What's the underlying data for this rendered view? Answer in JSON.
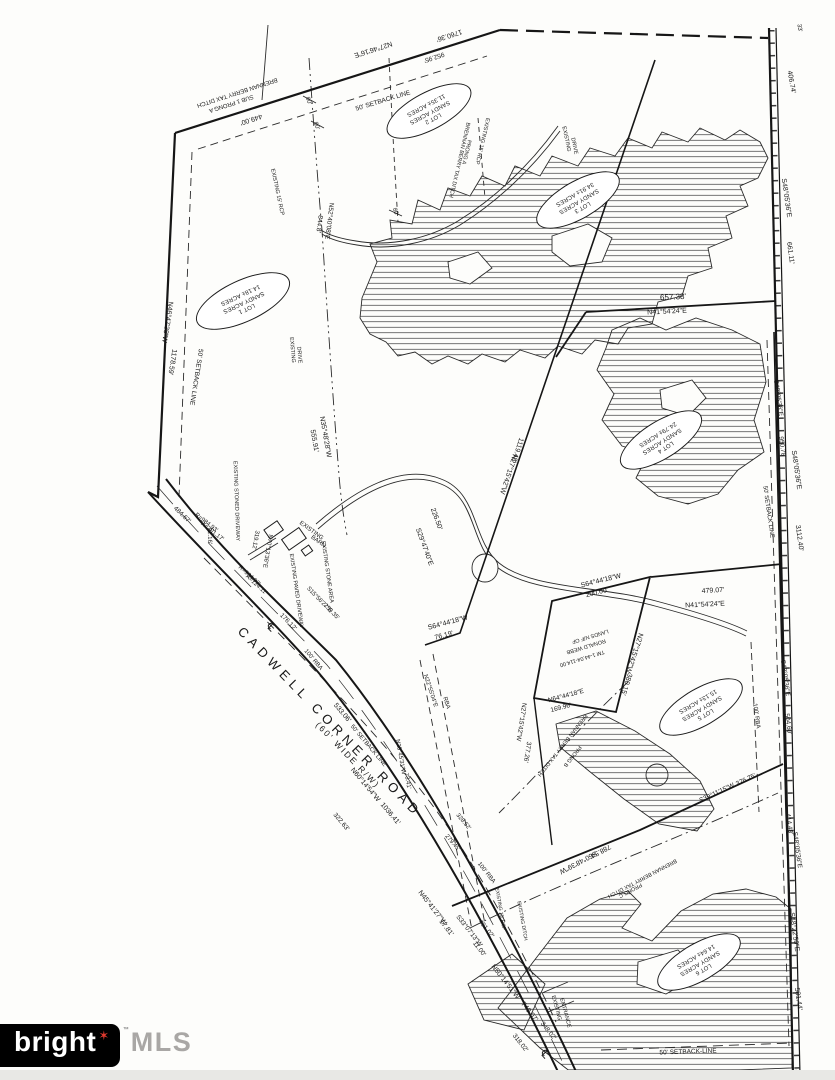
{
  "canvas": {
    "ink": "#1c1c1c",
    "paper": "#fdfdfb"
  },
  "logo": {
    "brand": "bright",
    "star": "✶",
    "tm": "™",
    "suffix": "MLS",
    "box_color": "#000000",
    "star_color": "#e0392e",
    "suffix_color": "#a9a7a5"
  },
  "road": {
    "name": "CADWELL CORNER ROAD",
    "width_label": "(60' WIDE R/W)",
    "centerline_symbol": "℄"
  },
  "lots": [
    {
      "lines": [
        "LOT 1",
        "SANDY ACRES",
        "14.18± ACRES"
      ],
      "x": 243,
      "y": 301,
      "r": 155,
      "w": 100,
      "h": 40
    },
    {
      "lines": [
        "LOT 2",
        "SANDY ACRES",
        "11.35± ACRES"
      ],
      "x": 429,
      "y": 111,
      "r": 152
    },
    {
      "lines": [
        "LOT 3",
        "SANDY ACRES",
        "34.91± ACRES"
      ],
      "x": 578,
      "y": 200,
      "r": 150
    },
    {
      "lines": [
        "LOT 4",
        "SANDY ACRES",
        "24.79± ACRES"
      ],
      "x": 661,
      "y": 440,
      "r": 148
    },
    {
      "lines": [
        "LOT 5",
        "SANDY ACRES",
        "15.13± ACRES"
      ],
      "x": 701,
      "y": 707,
      "r": 150
    },
    {
      "lines": [
        "LOT 6",
        "SANDY ACRES",
        "14.64± ACRES"
      ],
      "x": 699,
      "y": 962,
      "r": 150
    }
  ],
  "labels": [
    {
      "t": "N27°46'16\"E",
      "x": 373,
      "y": 49,
      "r": 162
    },
    {
      "t": "1760.36'",
      "x": 449,
      "y": 35,
      "r": 162
    },
    {
      "t": "952.95'",
      "x": 434,
      "y": 57,
      "r": 162,
      "s": 6.5
    },
    {
      "t": "50' SETBACK LINE",
      "x": 383,
      "y": 101,
      "r": -17,
      "s": 6.5
    },
    {
      "t": "449.00'",
      "x": 251,
      "y": 119,
      "r": 162
    },
    {
      "t": "BRENNAN BERRY TAX DITCH",
      "x": 237,
      "y": 92,
      "r": 162,
      "s": 6
    },
    {
      "t": "SUB 1 PRONG A",
      "x": 231,
      "y": 103,
      "r": 162,
      "s": 6
    },
    {
      "t": "80'",
      "x": 308,
      "y": 101,
      "r": 70,
      "s": 6
    },
    {
      "t": "80'",
      "x": 316,
      "y": 126,
      "r": 70,
      "s": 6
    },
    {
      "t": "80'",
      "x": 395,
      "y": 212,
      "r": 70,
      "s": 6
    },
    {
      "t": "EXISTING 15' RCP",
      "x": 277,
      "y": 192,
      "r": 78,
      "s": 5.5
    },
    {
      "t": "N52°40'08\"E",
      "x": 329,
      "y": 221,
      "r": 97,
      "s": 6.5
    },
    {
      "t": "844.8'",
      "x": 319,
      "y": 224,
      "r": 97,
      "s": 6.5
    },
    {
      "t": "EXISTING",
      "x": 566,
      "y": 139,
      "r": 78,
      "s": 5.5
    },
    {
      "t": "DRIVE",
      "x": 574,
      "y": 146,
      "r": 78,
      "s": 5.5
    },
    {
      "t": "BRENNAN BERRY TAX DITCH",
      "x": 459,
      "y": 160,
      "r": 103,
      "s": 5.5
    },
    {
      "t": "PRONG A",
      "x": 466,
      "y": 152,
      "r": 103,
      "s": 5.5
    },
    {
      "t": "EXISTING 15' RCP",
      "x": 482,
      "y": 141,
      "r": 103,
      "s": 5.5
    },
    {
      "t": "N46°47'38\"W",
      "x": 167,
      "y": 322,
      "r": 99
    },
    {
      "t": "1178.59'",
      "x": 172,
      "y": 362,
      "r": 99
    },
    {
      "t": "50' SETBACK LINE",
      "x": 196,
      "y": 377,
      "r": 99,
      "s": 6.5
    },
    {
      "t": "EXISTING",
      "x": 292,
      "y": 350,
      "r": 85,
      "s": 5.5
    },
    {
      "t": "DRIVE",
      "x": 299,
      "y": 355,
      "r": 85,
      "s": 5.5
    },
    {
      "t": "N35°48'28\"W",
      "x": 325,
      "y": 437,
      "r": 80
    },
    {
      "t": "555.91'",
      "x": 314,
      "y": 441,
      "r": 80
    },
    {
      "t": "S29°47'40\"E",
      "x": 424,
      "y": 547,
      "r": 70
    },
    {
      "t": "226.50'",
      "x": 436,
      "y": 519,
      "r": 70
    },
    {
      "t": "22.16'",
      "x": 209,
      "y": 536,
      "r": 88,
      "s": 6
    },
    {
      "t": "484.67'",
      "x": 182,
      "y": 515,
      "r": 44,
      "s": 6.5
    },
    {
      "t": "R=984.93'",
      "x": 206,
      "y": 523,
      "r": 38,
      "s": 6
    },
    {
      "t": "A=301.17'",
      "x": 212,
      "y": 532,
      "r": 38,
      "s": 6
    },
    {
      "t": "R=984.93'",
      "x": 249,
      "y": 576,
      "r": 42,
      "s": 6
    },
    {
      "t": "A=124.11'",
      "x": 256,
      "y": 585,
      "r": 42,
      "s": 6
    },
    {
      "t": "EXISTING STONED DRIVEWAY",
      "x": 236,
      "y": 501,
      "r": 88,
      "s": 5.5
    },
    {
      "t": "EXISTING PAVED DRIVEWAY",
      "x": 296,
      "y": 591,
      "r": 82,
      "s": 5.5
    },
    {
      "t": "EXISTING STONE AREA",
      "x": 327,
      "y": 572,
      "r": 82,
      "s": 5.5
    },
    {
      "t": "EXISTING",
      "x": 311,
      "y": 531,
      "r": 36,
      "s": 6
    },
    {
      "t": "BARN",
      "x": 318,
      "y": 542,
      "r": 36,
      "s": 6
    },
    {
      "t": "N70°13'36\"E",
      "x": 267,
      "y": 551,
      "r": 100,
      "s": 6
    },
    {
      "t": "319.12'",
      "x": 255,
      "y": 540,
      "r": 100,
      "s": 6
    },
    {
      "t": "S15°56'27\"E",
      "x": 319,
      "y": 600,
      "r": 46,
      "s": 6
    },
    {
      "t": "259.35'",
      "x": 331,
      "y": 612,
      "r": 46,
      "s": 6
    },
    {
      "t": "176.12'",
      "x": 288,
      "y": 622,
      "r": 46,
      "s": 6.5
    },
    {
      "t": "℄",
      "x": 271,
      "y": 627,
      "r": 45,
      "s": 11
    },
    {
      "t": "℄",
      "x": 545,
      "y": 1054,
      "r": 48,
      "s": 11
    },
    {
      "t": "CADWELL CORNER ROAD",
      "x": 330,
      "y": 722,
      "r": 46,
      "s": 13,
      "ls": 5,
      "n": "road-name-label"
    },
    {
      "t": "(60' WIDE R/W)",
      "x": 348,
      "y": 755,
      "r": 46,
      "s": 8.5,
      "ls": 2,
      "n": "road-width-label"
    },
    {
      "t": "533.06'",
      "x": 342,
      "y": 713,
      "r": 50
    },
    {
      "t": "50' SETBACK LINE",
      "x": 368,
      "y": 746,
      "r": 50,
      "s": 6
    },
    {
      "t": "N60°14'54\"W",
      "x": 365,
      "y": 785,
      "r": 50
    },
    {
      "t": "1036.41'",
      "x": 390,
      "y": 814,
      "r": 50
    },
    {
      "t": "322.63'",
      "x": 341,
      "y": 822,
      "r": 50,
      "s": 6.5
    },
    {
      "t": "100' RBA",
      "x": 313,
      "y": 660,
      "r": 50,
      "s": 6
    },
    {
      "t": "328.52'",
      "x": 463,
      "y": 822,
      "r": 50,
      "s": 6
    },
    {
      "t": "279.45'",
      "x": 452,
      "y": 843,
      "r": 50,
      "s": 6
    },
    {
      "t": "N45°41'27\"W",
      "x": 432,
      "y": 908,
      "r": 52
    },
    {
      "t": "17.81'",
      "x": 446,
      "y": 928,
      "r": 52
    },
    {
      "t": "S33°07'13\"W",
      "x": 469,
      "y": 931,
      "r": 52,
      "s": 6.5
    },
    {
      "t": "11.00'",
      "x": 479,
      "y": 949,
      "r": 52,
      "s": 6.5
    },
    {
      "t": "N50°14'51\"W",
      "x": 505,
      "y": 982,
      "r": 52
    },
    {
      "t": "749.07'",
      "x": 529,
      "y": 1012,
      "r": 52
    },
    {
      "t": "348.02'",
      "x": 548,
      "y": 1031,
      "r": 52,
      "s": 6.5
    },
    {
      "t": "318.02'",
      "x": 520,
      "y": 1043,
      "r": 52,
      "s": 6.5
    },
    {
      "t": "401.02'",
      "x": 486,
      "y": 929,
      "r": 52,
      "s": 6.5
    },
    {
      "t": "100' RBA",
      "x": 486,
      "y": 873,
      "r": 52,
      "s": 6
    },
    {
      "t": "EXISTING 15' RCP",
      "x": 500,
      "y": 909,
      "r": 80,
      "s": 5
    },
    {
      "t": "EXISTING DITCH",
      "x": 522,
      "y": 921,
      "r": 80,
      "s": 5
    },
    {
      "t": "N22°55'04\"E",
      "x": 430,
      "y": 691,
      "r": 72,
      "s": 6
    },
    {
      "t": "RBA",
      "x": 446,
      "y": 703,
      "r": 72,
      "s": 6
    },
    {
      "t": "N23°45'31\"W",
      "x": 400,
      "y": 757,
      "r": 80,
      "s": 6
    },
    {
      "t": "73.41'",
      "x": 407,
      "y": 781,
      "r": 80,
      "s": 6
    },
    {
      "t": "EXISTING",
      "x": 556,
      "y": 1008,
      "r": 75,
      "s": 5.5
    },
    {
      "t": "ENTRANCE",
      "x": 565,
      "y": 1013,
      "r": 75,
      "s": 5.5
    },
    {
      "t": "S64°44'18\"W",
      "x": 448,
      "y": 623,
      "r": -15
    },
    {
      "t": "76.19'",
      "x": 444,
      "y": 636,
      "r": -15
    },
    {
      "t": "N27°15'42\"W",
      "x": 508,
      "y": 474,
      "r": 108
    },
    {
      "t": "1119.48'",
      "x": 517,
      "y": 450,
      "r": 108
    },
    {
      "t": "657.38'",
      "x": 673,
      "y": 297,
      "r": -3,
      "s": 8
    },
    {
      "t": "N41°54'24\"E",
      "x": 667,
      "y": 312,
      "r": -3
    },
    {
      "t": "479.07'",
      "x": 713,
      "y": 591,
      "r": -3
    },
    {
      "t": "N41°54'24\"E",
      "x": 705,
      "y": 605,
      "r": -3
    },
    {
      "t": "S64°44'18\"W",
      "x": 601,
      "y": 581,
      "r": -14
    },
    {
      "t": "200.00'",
      "x": 597,
      "y": 593,
      "r": -14
    },
    {
      "t": "LANDS N/F OF",
      "x": 590,
      "y": 636,
      "r": 163,
      "s": 5.5
    },
    {
      "t": "RONALD WEBB",
      "x": 586,
      "y": 646,
      "r": 163,
      "s": 5.5
    },
    {
      "t": "TM 1-44.04-114.00",
      "x": 582,
      "y": 658,
      "r": 163,
      "s": 5.5
    },
    {
      "t": "N27°15'42\"W",
      "x": 634,
      "y": 653,
      "r": 108
    },
    {
      "t": "380.15'",
      "x": 626,
      "y": 684,
      "r": 108
    },
    {
      "t": "N64°44'18\"E",
      "x": 566,
      "y": 696,
      "r": -15,
      "s": 6.5
    },
    {
      "t": "169.96'",
      "x": 561,
      "y": 708,
      "r": -15,
      "s": 6.5
    },
    {
      "t": "N27°15'42\"W",
      "x": 521,
      "y": 722,
      "r": 99,
      "s": 6.5
    },
    {
      "t": "377.26'",
      "x": 527,
      "y": 752,
      "r": 99,
      "s": 6.5
    },
    {
      "t": "BRENNAN BERRY TAX DITCH",
      "x": 562,
      "y": 745,
      "r": 128,
      "s": 5.5
    },
    {
      "t": "PRONG B",
      "x": 572,
      "y": 756,
      "r": 128,
      "s": 5.5
    },
    {
      "t": "S60°48'39\"W",
      "x": 578,
      "y": 862,
      "r": 152
    },
    {
      "t": "788.54'",
      "x": 600,
      "y": 851,
      "r": 152
    },
    {
      "t": "BRENNAN BERRY TAX DITCH",
      "x": 642,
      "y": 878,
      "r": 152,
      "s": 5.5
    },
    {
      "t": "PRONG C",
      "x": 630,
      "y": 890,
      "r": 152,
      "s": 5.5
    },
    {
      "t": "S39°11'15\"W",
      "x": 717,
      "y": 793,
      "r": -25,
      "s": 6.5
    },
    {
      "t": "376.75'",
      "x": 746,
      "y": 780,
      "r": -25,
      "s": 6.5
    },
    {
      "t": "33'",
      "x": 799,
      "y": 28,
      "r": 80,
      "s": 6
    },
    {
      "t": "406.74'",
      "x": 791,
      "y": 82,
      "r": 80
    },
    {
      "t": "S48°05'36\"E",
      "x": 786,
      "y": 198,
      "r": 82
    },
    {
      "t": "661.11'",
      "x": 790,
      "y": 253,
      "r": 82
    },
    {
      "t": "S48°05'36\"E",
      "x": 778,
      "y": 398,
      "r": 82,
      "s": 6.5
    },
    {
      "t": "950.78'",
      "x": 782,
      "y": 447,
      "r": 82,
      "s": 6.5
    },
    {
      "t": "S48°05'36\"E",
      "x": 796,
      "y": 470,
      "r": 82
    },
    {
      "t": "3112.40'",
      "x": 799,
      "y": 538,
      "r": 82
    },
    {
      "t": "50' SETBACK LINE",
      "x": 768,
      "y": 512,
      "r": 82,
      "s": 6
    },
    {
      "t": "100' RBA",
      "x": 756,
      "y": 716,
      "r": 82,
      "s": 6
    },
    {
      "t": "S48°05'36\"E",
      "x": 785,
      "y": 678,
      "r": 82,
      "s": 6.5
    },
    {
      "t": "504.60'",
      "x": 788,
      "y": 724,
      "r": 82,
      "s": 6.5
    },
    {
      "t": "414.48'",
      "x": 789,
      "y": 824,
      "r": 82,
      "s": 6.5
    },
    {
      "t": "S48°05'36\"E",
      "x": 797,
      "y": 850,
      "r": 82,
      "s": 6.5
    },
    {
      "t": "S48°22'50\"E",
      "x": 794,
      "y": 932,
      "r": 82
    },
    {
      "t": "581.44'",
      "x": 798,
      "y": 999,
      "r": 82
    },
    {
      "t": "50' SETBACK-LINE",
      "x": 688,
      "y": 1052,
      "r": -2,
      "s": 6.5
    }
  ]
}
